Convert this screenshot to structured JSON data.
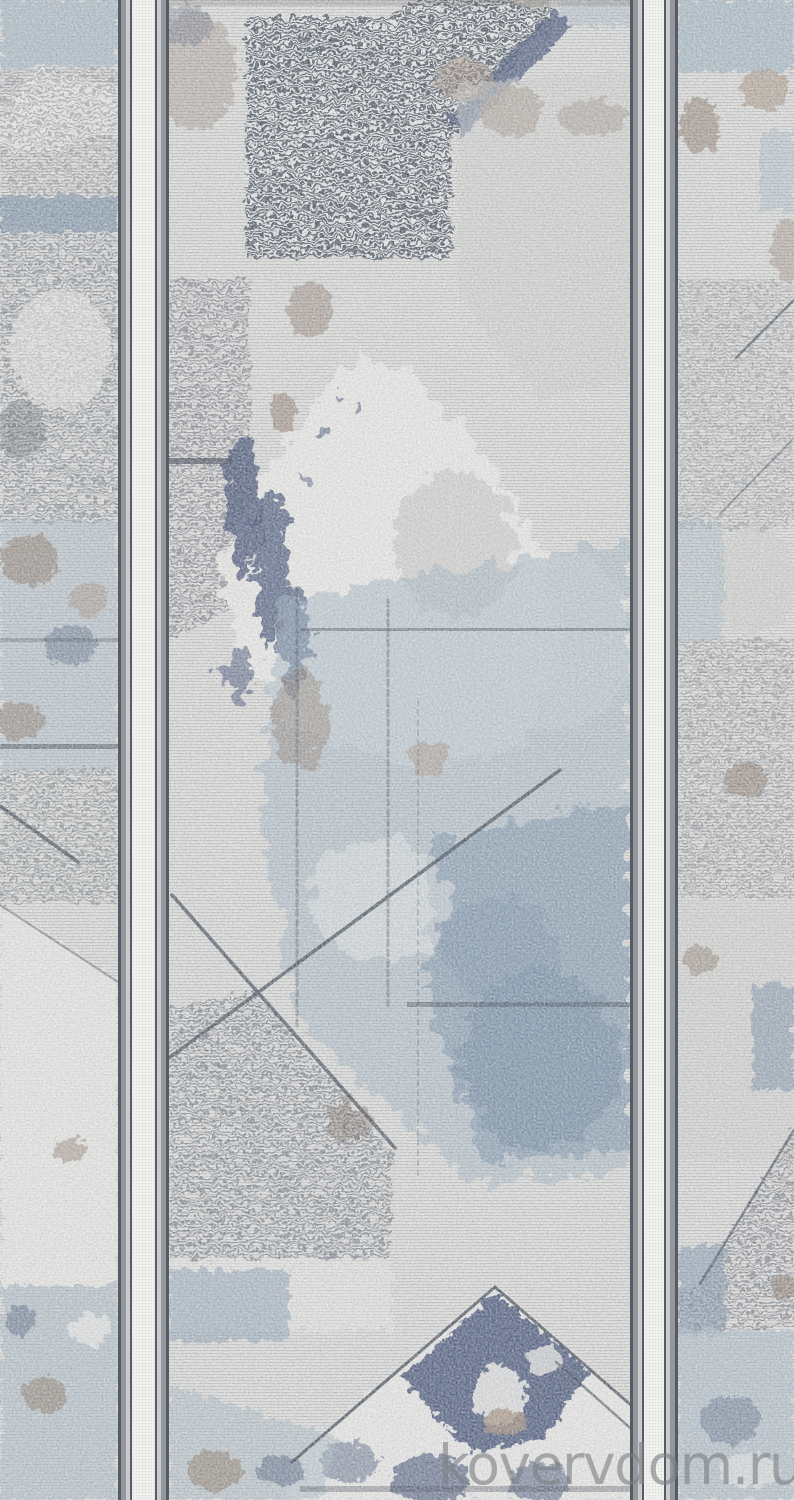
{
  "watermark": {
    "text": "kovervdom.ru"
  },
  "palette": {
    "base": "#e9e8e4",
    "ink": "#3b4350",
    "stripe_dark": "#4e565e",
    "navy": "#3f4f74",
    "denim": "#7b93ab",
    "deep_denim": "#6d86a2",
    "steel": "#9db4c4",
    "blue_gray": "#a9bbc7",
    "brown": "#8d7867",
    "taupe": "#a6907d",
    "light_patch": "#f2f1ed",
    "gray_patch": "#d4d4d0",
    "band_dark": "#565c63",
    "band_gray": "#94989c",
    "band_light": "#c9cbcd",
    "band_white": "#f1f1ef",
    "band_dot": "#d9d9d5",
    "watermark_color": "#7d8084"
  }
}
